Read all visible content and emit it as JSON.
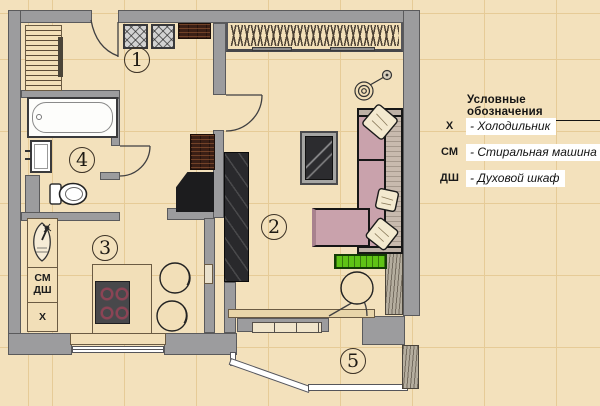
{
  "legend": {
    "title": "Условные обозначения",
    "items": [
      {
        "abbr": "Х",
        "label": "- Холодильник"
      },
      {
        "abbr": "СМ",
        "label": "- Стиральная машина"
      },
      {
        "abbr": "ДШ",
        "label": "- Духовой шкаф"
      }
    ]
  },
  "rooms": [
    {
      "number": "1"
    },
    {
      "number": "2"
    },
    {
      "number": "3"
    },
    {
      "number": "4"
    },
    {
      "number": "5"
    }
  ],
  "kitchen": {
    "washer_label": "СМ",
    "oven_label": "ДШ",
    "fridge_label": "Х"
  },
  "colors": {
    "background": "#f3e1bc",
    "grid": "#e6cb97",
    "wall": "#9c9c9e",
    "sofa_pink": "#c9a2ac",
    "planter_green": "#5fc316",
    "wood_brown": "#3b1f15",
    "legend_strip": "#ffffff"
  }
}
